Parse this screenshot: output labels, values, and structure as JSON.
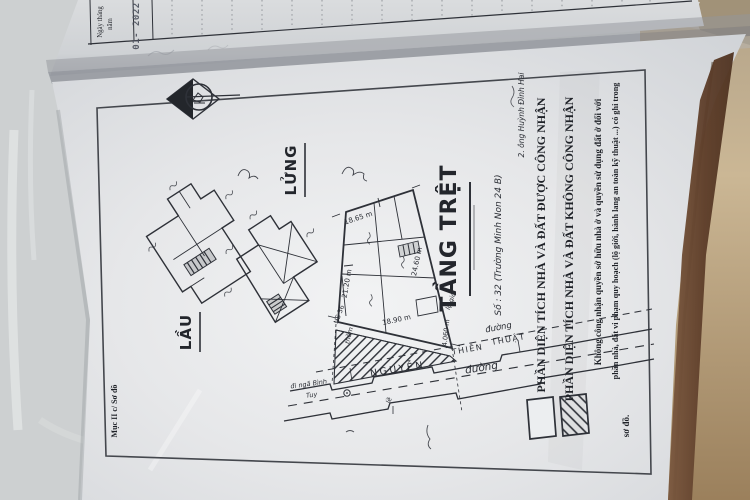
{
  "document": {
    "kind": "Photographed cadastral sketch page (sơ đồ nhà đất) in an opened certificate booklet",
    "margin_label": "Mục II c/ Sơ đồ",
    "owner_note": "2. ông Huỳnh Đình Hai"
  },
  "date_table": {
    "header_line1": "Ngày tháng",
    "header_line2": "năm",
    "stamp_value": "01- 2022"
  },
  "floor_plans": {
    "lau_label": "LẦU",
    "lung_label": "LỬNG",
    "tret_label": "TẦNG TRỆT",
    "tret_note": "Số : 32 (Trường Minh Non 24 B)",
    "dim_top": "18.65 m",
    "dim_left": "21.20 m",
    "dim_right": "24.60 m",
    "dim_bottom": "18.90 m",
    "dim_setback": "4.060 m",
    "house_ref": "NS 36",
    "porch_label": "thềm",
    "boundary_label": "lộ giới"
  },
  "street": {
    "name_1": "NGUYỄN",
    "name_2": "THIÊN",
    "name_3": "THUẬT",
    "duong_1": "đường",
    "duong_2": "đường",
    "curb_label": "lề",
    "direction_1": "đi ngã Bình",
    "direction_2": "Tuy"
  },
  "legend": {
    "recognized": "PHẦN DIỆN TÍCH NHÀ VÀ ĐẤT ĐƯỢC CÔNG NHẬN",
    "not_recognized": "PHẦN DIỆN TÍCH NHÀ VÀ ĐẤT KHÔNG CÔNG NHẬN",
    "note_line1": "Không công nhận quyền sở hữu nhà ở và quyền sử dụng đất ở đối với",
    "note_line2": "phần nhà, đất vi phạm quy hoạch (lộ giới, hành lang an toàn kỹ thuật ...) có ghi trong",
    "note_line3": "sơ đồ."
  },
  "colors": {
    "paper": "#e8e9eb",
    "ink": "#2e3138",
    "fabric": "#cdd0d1",
    "wood_edge": "#6e4d35",
    "beige_edge": "#bfae8e"
  }
}
